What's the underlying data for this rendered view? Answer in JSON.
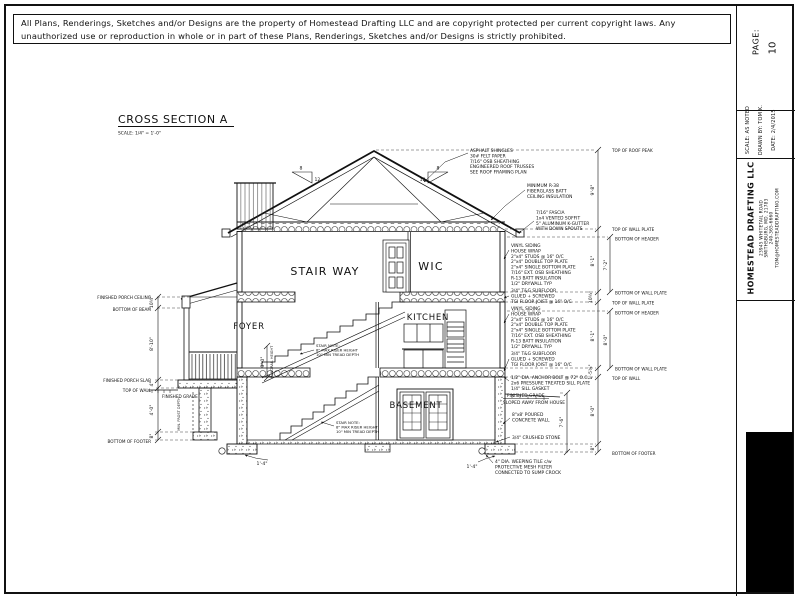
{
  "copyright": "All Plans, Renderings, Sketches and/or Designs are the property of Homestead Drafting LLC and are copyright protected per current copyright laws. Any unauthorized use or reproduction in whole or in part of these Plans, Renderings, Sketches and/or Designs is strictly prohibited.",
  "title_block": {
    "page_label": "PAGE:",
    "page_number": "10",
    "scale": "SCALE:  AS NOTED",
    "drawn_by": "DRAWN BY: TOM K.",
    "date": "DATE:  2/4/2015",
    "company": "HOMESTEAD DRAFTING LLC",
    "address_line1": "23945 WHITETAIL ROAD",
    "address_line2": "SMITHSBURG, MD. 21783",
    "phone": "240-365-6660",
    "email": "TOM@HOMESTEADDRAFTING.COM"
  },
  "drawing": {
    "title": "CROSS SECTION A",
    "scale_note": "SCALE:   1/4\" = 1'-0\"",
    "rooms": {
      "stairway": "STAIR WAY",
      "wic": "WIC",
      "foyer": "FOYER",
      "kitchen": "KITCHEN",
      "basement": "BASEMENT"
    },
    "roof_pitch": {
      "rise": "8",
      "run": "12"
    },
    "callouts": {
      "roof": [
        "ASPHALT SHINGLES",
        "30# FELT PAPER",
        "7/16\" OSB SHEATHING",
        "ENGINEERED ROOF TRUSSES",
        "SEE ROOF FRAMING PLAN"
      ],
      "ceiling": [
        "MINIMUM R-38",
        "FIBERGLASS BATT",
        "CEILING INSULATION"
      ],
      "eave": [
        "7/16\" FASCIA",
        "1x4 VENTED SOFFIT",
        "5\" ALUMINUM K-GUTTER",
        "WITH DOWN SPOUTS"
      ],
      "wall": [
        "VINYL SIDING",
        "HOUSE WRAP",
        "2\"x4\" STUDS @ 16\" O/C",
        "2\"x4\" DOUBLE TOP PLATE",
        "2\"x4\" SINGLE BOTTOM PLATE",
        "7/16\" EXT. OSB SHEATHING",
        "R-13 BATT INSULATION",
        "1/2\" DRYWALL TYP"
      ],
      "floor": [
        "3/4\" T&G SUBFLOOR",
        "GLUED + SCREWED",
        "TGI FLOOR JOIST @ 16\" O/C"
      ],
      "sill": [
        "1/2\" DIA. ANCHOR BOLT @ 72\" O.C.",
        "2x6 PRESSURE TREATED SILL PLATE",
        "1/4\" SILL GASKET"
      ],
      "grade": [
        "FINISHED GRADE",
        "SLOPED AWAY FROM HOUSE"
      ],
      "foundation_wall": [
        "8\"x8' POURED",
        "CONCRETE WALL"
      ],
      "stone": "3/4\" CRUSHED STONE",
      "weeping": [
        "4\" DIA. WEEPING TILE c/w",
        "PROTECTIVE MESH FILTER",
        "CONNECTED TO SUMP CROCK"
      ],
      "stair_note": [
        "STAIR NOTE:",
        "8\" MAX RISER HEIGHT",
        "10\" MIN TREAD DEPTH"
      ],
      "grade_left": "FINISHED GRADE",
      "frost": "MIN. FROST DEPTH",
      "handrail_dim": "3'-0\"",
      "handrail_label": "HANDRAIL HEIGHT"
    },
    "dims_right": {
      "peak_label": "TOP OF ROOF PEAK",
      "peak_to_plate": "9'-8\"",
      "top_plate": "TOP OF WALL PLATE",
      "bottom_header": "BOTTOM OF HEADER",
      "second_floor_height": "8'-1\"",
      "second_header_height": "7'-2\"",
      "second_floor_depth": "10¾\"",
      "bottom_plate": "BOTTOM OF WALL PLATE",
      "first_floor_height": "8'-1\"",
      "first_header_height": "8'-0\"",
      "first_floor_depth": "1'-5¾\"",
      "top_wall": "TOP OF WALL",
      "basement_height": "8'-0\"",
      "below_grade": "7'-6\"",
      "footer_depth": "8\"",
      "bottom_footer": "BOTTOM OF FOOTER"
    },
    "dims_left": {
      "porch_ceiling": "FINISHED PORCH CEILING",
      "bottom_beam": "BOTTOM OF BEAM",
      "beam_depth": "10¾\"",
      "porch_height": "8'-10\"",
      "porch_slab": "FINISHED PORCH SLAB",
      "slab_depth": "4\"",
      "top_wall": "TOP OF WALL",
      "frost_depth": "4'-0\"",
      "footer_depth": "8\"",
      "bottom_footer": "BOTTOM OF FOOTER"
    },
    "footer_width": "1'-4\""
  }
}
